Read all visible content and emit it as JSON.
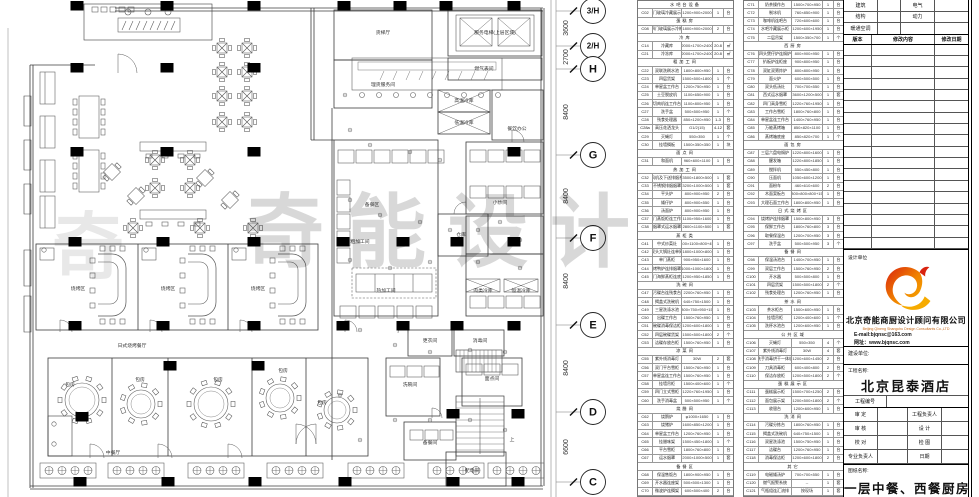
{
  "watermark": {
    "text": "奇能设计",
    "text2": "奇"
  },
  "plan": {
    "room_labels": [
      {
        "t": "服务电梯(上层区域)",
        "x": 495,
        "y": 34
      },
      {
        "t": "燃气表间",
        "x": 484,
        "y": 70
      },
      {
        "t": "货梯厅",
        "x": 383,
        "y": 34
      },
      {
        "t": "理货服务间",
        "x": 383,
        "y": 86
      },
      {
        "t": "餐饮办公",
        "x": 517,
        "y": 130
      },
      {
        "t": "高温冷库",
        "x": 464,
        "y": 102
      },
      {
        "t": "低温冷库",
        "x": 464,
        "y": 124
      },
      {
        "t": "备餐区",
        "x": 372,
        "y": 206
      },
      {
        "t": "粗加工间",
        "x": 360,
        "y": 243
      },
      {
        "t": "热加工间",
        "x": 386,
        "y": 292
      },
      {
        "t": "小炒间",
        "x": 500,
        "y": 204
      },
      {
        "t": "仓库",
        "x": 461,
        "y": 236
      },
      {
        "t": "肉类冷库",
        "x": 483,
        "y": 292
      },
      {
        "t": "恒温冷库",
        "x": 521,
        "y": 292
      },
      {
        "t": "更衣间",
        "x": 430,
        "y": 342
      },
      {
        "t": "消毒间",
        "x": 480,
        "y": 342
      },
      {
        "t": "洗碗间",
        "x": 410,
        "y": 386
      },
      {
        "t": "面点间",
        "x": 492,
        "y": 380
      },
      {
        "t": "备餐间",
        "x": 430,
        "y": 444
      },
      {
        "t": "配电间",
        "x": 472,
        "y": 472
      },
      {
        "t": "上",
        "x": 512,
        "y": 441
      },
      {
        "t": "烧烤区",
        "x": 78,
        "y": 290
      },
      {
        "t": "烧烤区",
        "x": 168,
        "y": 290
      },
      {
        "t": "烧烤区",
        "x": 258,
        "y": 290
      },
      {
        "t": "日式烧烤餐厅",
        "x": 132,
        "y": 347
      },
      {
        "t": "中餐厅",
        "x": 113,
        "y": 454
      },
      {
        "t": "包房",
        "x": 70,
        "y": 386
      },
      {
        "t": "包房",
        "x": 140,
        "y": 381
      },
      {
        "t": "包房",
        "x": 218,
        "y": 381
      },
      {
        "t": "包房",
        "x": 283,
        "y": 372
      },
      {
        "t": "包房",
        "x": 322,
        "y": 404
      }
    ],
    "dimensions": [
      {
        "value": "3600",
        "y": 28
      },
      {
        "value": "2700",
        "y": 57
      },
      {
        "value": "8400",
        "y": 112
      },
      {
        "value": "8400",
        "y": 196
      },
      {
        "value": "8400",
        "y": 281
      },
      {
        "value": "8400",
        "y": 368
      },
      {
        "value": "6600",
        "y": 447
      }
    ],
    "grid_bubbles": [
      {
        "label": "3/H",
        "y": 11
      },
      {
        "label": "2/H",
        "y": 46
      },
      {
        "label": "H",
        "y": 69
      },
      {
        "label": "G",
        "y": 155
      },
      {
        "label": "F",
        "y": 238
      },
      {
        "label": "E",
        "y": 325
      },
      {
        "label": "D",
        "y": 412
      },
      {
        "label": "C",
        "y": 482
      }
    ]
  },
  "equipment_tables": {
    "left": {
      "rows": [
        {
          "s": "水吧台设备"
        },
        [
          "C02",
          "双门玻璃冷藏展示柜",
          "1200×900×2000",
          "1",
          "台"
        ],
        {
          "s": "蛋糕房"
        },
        [
          "C08",
          "四门玻璃展示冷柜",
          "1800×900×2000",
          "2",
          "台"
        ],
        {
          "s": "冷库"
        },
        [
          "C14",
          "冷藏库",
          "2000×1700×2400",
          "20.8",
          "㎡"
        ],
        [
          "C21",
          "冷冻库",
          "2000×1700×2400",
          "20.8",
          "㎡"
        ],
        {
          "s": "粗加工间"
        },
        [
          "C22",
          "双联洗刷水池",
          "1800×800×950",
          "1",
          "台"
        ],
        [
          "C23",
          "四层货架",
          "1500×500×1800",
          "1",
          "个"
        ],
        [
          "C24",
          "单星盆工作台",
          "1200×750×950",
          "1",
          "台"
        ],
        [
          "C25",
          "土豆脱皮机",
          "1100×650×900",
          "1",
          "台"
        ],
        [
          "C26",
          "绞切肉机连工作台柜",
          "1100×800×950",
          "1",
          "台"
        ],
        [
          "C27",
          "洗手盆",
          "500×500×950",
          "1",
          "个"
        ],
        [
          "C28",
          "残食处理器",
          "850×1200×950",
          "1-3",
          "台"
        ],
        [
          "C28a",
          "高压花洒龙头",
          "G1/2(15)",
          "4-12",
          "套"
        ],
        [
          "C29",
          "灭蝇灯",
          "550×350",
          "1",
          "个"
        ],
        [
          "C30",
          "挂墙搁板",
          "1500×350×350",
          "1",
          "块"
        ],
        {
          "s": "面点间"
        },
        [
          "C31",
          "和面机",
          "960×600×1100",
          "1",
          "台"
        ],
        {
          "s": "热加工间"
        },
        [
          "C32",
          "鼓风机及下送排烟系统",
          "3500×1800×500",
          "1",
          "套"
        ],
        [
          "C33",
          "不锈钢排烟烟罩",
          "3200×1000×500",
          "1",
          "套"
        ],
        [
          "C34",
          "平头炉",
          "800×900×950",
          "2",
          "台"
        ],
        [
          "C35",
          "矮仔炉",
          "800×900×550",
          "1",
          "台"
        ],
        [
          "C36",
          "汤面炉",
          "800×900×950",
          "1",
          "台"
        ],
        [
          "C37",
          "双门蒸饭柜连工作台",
          "1100×950×1600",
          "1",
          "台"
        ],
        [
          "C38",
          "烟罩式运水烟罩",
          "2800×1100×500",
          "1",
          "套"
        ],
        {
          "s": "蒸柜类"
        },
        [
          "C41",
          "中式炒菜灶",
          "2400×1100×800+450",
          "1",
          "台"
        ],
        [
          "C42",
          "双头大锅灶连单尾",
          "1800×1000×800",
          "1",
          "台"
        ],
        [
          "C43",
          "单门蒸柜",
          "900×950×1600",
          "1",
          "台"
        ],
        [
          "C44",
          "烤鸭炉连排烟罩",
          "1000×1000×1800",
          "1",
          "台"
        ],
        [
          "C45",
          "四门海鲜蒸柜连底座",
          "1200×950×1850",
          "1",
          "台"
        ],
        {
          "s": "洗碗间"
        },
        [
          "C47",
          "污碟台连残食台",
          "2200×760×950",
          "1",
          "台"
        ],
        [
          "C48",
          "揭盖式洗碗机",
          "640×750×1500",
          "1",
          "台"
        ],
        [
          "C49",
          "三星洗涤水池",
          "1800×750×950+150",
          "1",
          "台"
        ],
        [
          "C50",
          "出碟工作台",
          "1500×760×950",
          "1",
          "台"
        ],
        [
          "C51",
          "碗碟消毒保洁柜",
          "1200×600×1800",
          "1",
          "台"
        ],
        [
          "C52",
          "四层碗碟货架",
          "1500×500×1800",
          "2",
          "个"
        ],
        [
          "C53",
          "洁碟存放台柜",
          "1500×760×950",
          "1",
          "台"
        ],
        {
          "s": "凉菜间"
        },
        [
          "C55",
          "紫外线消毒灯",
          "30W",
          "2",
          "套"
        ],
        [
          "C56",
          "双门平台雪柜",
          "1500×760×950",
          "1",
          "台"
        ],
        [
          "C57",
          "单星盆连工作台",
          "1500×760×950",
          "1",
          "台"
        ],
        [
          "C58",
          "挂墙吊柜",
          "1500×400×600",
          "1",
          "个"
        ],
        [
          "C59",
          "四门立式雪柜",
          "1220×760×1950",
          "1",
          "台"
        ],
        [
          "C60",
          "洗手消毒盆",
          "500×500×950",
          "1",
          "个"
        ],
        {
          "s": "烧腊间"
        },
        [
          "C62",
          "烧鹅炉",
          "φ1000×1650",
          "1",
          "台"
        ],
        [
          "C63",
          "烧猪炉",
          "1600×850×1200",
          "1",
          "台"
        ],
        [
          "C64",
          "单星盆工作台",
          "1200×760×950",
          "1",
          "台"
        ],
        [
          "C65",
          "挂腊味架",
          "1500×450×1800",
          "1",
          "个"
        ],
        [
          "C66",
          "平台雪柜",
          "1800×760×800",
          "1",
          "台"
        ],
        [
          "C67",
          "运水烟罩",
          "2000×1000×500",
          "1",
          "套"
        ],
        {
          "s": "备餐区"
        },
        [
          "C68",
          "保温售饭台",
          "1800×900×950",
          "1",
          "台"
        ],
        [
          "C69",
          "开水器连座架",
          "500×500×1300",
          "1",
          "台"
        ],
        [
          "C70",
          "微波炉连搁架",
          "600×500×400",
          "2",
          "台"
        ]
      ]
    },
    "right": {
      "rows": [
        [
          "C71",
          "奶茶操作台",
          "1500×700×950",
          "1",
          "台"
        ],
        [
          "C72",
          "制冰机",
          "760×850×900",
          "1",
          "台"
        ],
        [
          "C73",
          "咖啡机连吧台",
          "720×600×600",
          "1",
          "台"
        ],
        [
          "C74",
          "水吧冷藏展示柜",
          "1200×600×1950",
          "1",
          "台"
        ],
        [
          "C75",
          "二层吊架",
          "1500×350×700",
          "1",
          "个"
        ],
        {
          "s": "西厨房"
        },
        [
          "C76",
          "四头煲仔炉连焗炉",
          "800×900×950",
          "1",
          "台"
        ],
        [
          "C77",
          "扒板炉连柜座",
          "900×800×950",
          "1",
          "台"
        ],
        [
          "C78",
          "双缸双筛炸炉",
          "800×800×950",
          "1",
          "台"
        ],
        [
          "C79",
          "面火炉",
          "600×500×500",
          "1",
          "台"
        ],
        [
          "C80",
          "双头低汤灶",
          "700×700×550",
          "1",
          "台"
        ],
        [
          "C81",
          "西式运水烟罩",
          "3600×1200×500",
          "1",
          "套"
        ],
        [
          "C82",
          "四门高身雪柜",
          "1220×760×1950",
          "1",
          "台"
        ],
        [
          "C83",
          "工作台雪柜",
          "1800×760×800",
          "1",
          "台"
        ],
        [
          "C84",
          "单星盆连工作台",
          "1400×760×950",
          "1",
          "台"
        ],
        [
          "C85",
          "万能蒸烤箱",
          "850×820×1100",
          "1",
          "台"
        ],
        [
          "C86",
          "蒸烤箱底座",
          "850×820×700",
          "1",
          "个"
        ],
        {
          "s": "面包房"
        },
        [
          "C87",
          "三层六盘电焗炉",
          "1220×800×1600",
          "1",
          "台"
        ],
        [
          "C88",
          "醒发箱",
          "1220×800×1850",
          "1",
          "台"
        ],
        [
          "C89",
          "搅拌机",
          "550×450×800",
          "1",
          "台"
        ],
        [
          "C90",
          "压面机",
          "1050×600×1200",
          "1",
          "台"
        ],
        [
          "C91",
          "面粉车",
          "460×610×600",
          "2",
          "台"
        ],
        [
          "C92",
          "木面案板台",
          "1800×800×800+150",
          "1",
          "台"
        ],
        [
          "C93",
          "大理石面工作台",
          "1800×800×950",
          "1",
          "台"
        ],
        {
          "s": "日式烧烤区"
        },
        [
          "C94",
          "烧烤炉连排烟罩",
          "1500×800×950",
          "3",
          "台"
        ],
        [
          "C95",
          "保鲜工作台",
          "1800×760×800",
          "3",
          "台"
        ],
        [
          "C96",
          "取餐保温台",
          "1200×700×950",
          "3",
          "台"
        ],
        [
          "C97",
          "洗手盆",
          "500×500×950",
          "3",
          "个"
        ],
        {
          "s": "备餐间"
        },
        [
          "C98",
          "保温汤池台",
          "1400×700×950",
          "1",
          "台"
        ],
        [
          "C99",
          "双层工作台",
          "1500×760×950",
          "2",
          "台"
        ],
        [
          "C100",
          "开水器",
          "500×500×800",
          "1",
          "台"
        ],
        [
          "C101",
          "四层货架",
          "1500×500×1800",
          "2",
          "个"
        ],
        [
          "C102",
          "残食处理台",
          "1200×760×950",
          "1",
          "台"
        ],
        {
          "s": "茶水间"
        },
        [
          "C103",
          "茶水柜台",
          "1500×600×950",
          "1",
          "台"
        ],
        [
          "C104",
          "挂墙吊柜",
          "1200×400×600",
          "1",
          "个"
        ],
        [
          "C105",
          "洗杯水池台",
          "1200×600×950",
          "1",
          "台"
        ],
        {
          "s": "公共区域"
        },
        [
          "C106",
          "灭蝇灯",
          "550×350",
          "4",
          "个"
        ],
        [
          "C107",
          "紫外线消毒灯",
          "30W",
          "4",
          "套"
        ],
        [
          "C108",
          "洗手消毒烘干一体机",
          "1200×600×1450",
          "2",
          "台"
        ],
        [
          "C109",
          "刀具消毒柜",
          "600×400×800",
          "2",
          "台"
        ],
        [
          "C110",
          "保洁存放柜",
          "1200×500×1800",
          "2",
          "个"
        ],
        {
          "s": "蛋糕展示区"
        },
        [
          "C111",
          "蛋糕展示柜",
          "1500×700×1250",
          "2",
          "台"
        ],
        [
          "C112",
          "面包展示架",
          "1200×500×1800",
          "2",
          "个"
        ],
        [
          "C113",
          "收银台",
          "1200×600×950",
          "1",
          "台"
        ],
        {
          "s": "洗消间"
        },
        [
          "C114",
          "污碟分拣台",
          "1800×760×950",
          "1",
          "台"
        ],
        [
          "C115",
          "揭盖式洗碗机",
          "640×750×1500",
          "1",
          "台"
        ],
        [
          "C116",
          "双星洗涤池",
          "1500×750×950",
          "1",
          "台"
        ],
        [
          "C117",
          "洁碟台",
          "1200×760×950",
          "1",
          "台"
        ],
        [
          "C118",
          "消毒保洁柜",
          "1200×600×1800",
          "2",
          "台"
        ],
        {
          "s": "其它"
        },
        [
          "C119",
          "电磁矮汤炉",
          "700×700×550",
          "1",
          "台"
        ],
        [
          "C120",
          "燃气报警系统",
          "--",
          "1",
          "套"
        ],
        [
          "C121",
          "气瓶组连汇流排",
          "按现场",
          "1",
          "套"
        ]
      ]
    }
  },
  "title_block": {
    "top_rows": [
      [
        "建筑",
        "电气"
      ],
      [
        "结构",
        "动力"
      ],
      [
        "暖通空调",
        ""
      ]
    ],
    "revision": {
      "headers": [
        "版本",
        "修改内容",
        "修改日期"
      ],
      "empty_rows": 18
    },
    "design_unit_label": "设计单位",
    "company_cn": "北京奇能商厨设计顾问有限公司",
    "company_en": "Beijing Qineng Shangchu Design Consultants Co.,LTD",
    "email": "E-mail:bjqnsc@163.com",
    "website": "网址：www.bjqnsc.com",
    "build_unit_label": "建设单位:",
    "project_label": "工程名称:",
    "project_name": "北京昆泰酒店",
    "project_no_label": "工程编号",
    "sign_rows": [
      [
        "审  定",
        "工程负责人"
      ],
      [
        "审  核",
        "设  计"
      ],
      [
        "校  对",
        "检  图"
      ],
      [
        "专业负责人",
        "日期"
      ]
    ],
    "drawing_label": "图纸名称:",
    "drawing_name": "一层中餐、西餐厨房"
  },
  "colors": {
    "logo_red": "#d9230f",
    "logo_orange": "#f08300",
    "logo_yellow": "#f6ab00",
    "column_black": "#000000",
    "watermark_gray": "#cfcfcf"
  }
}
